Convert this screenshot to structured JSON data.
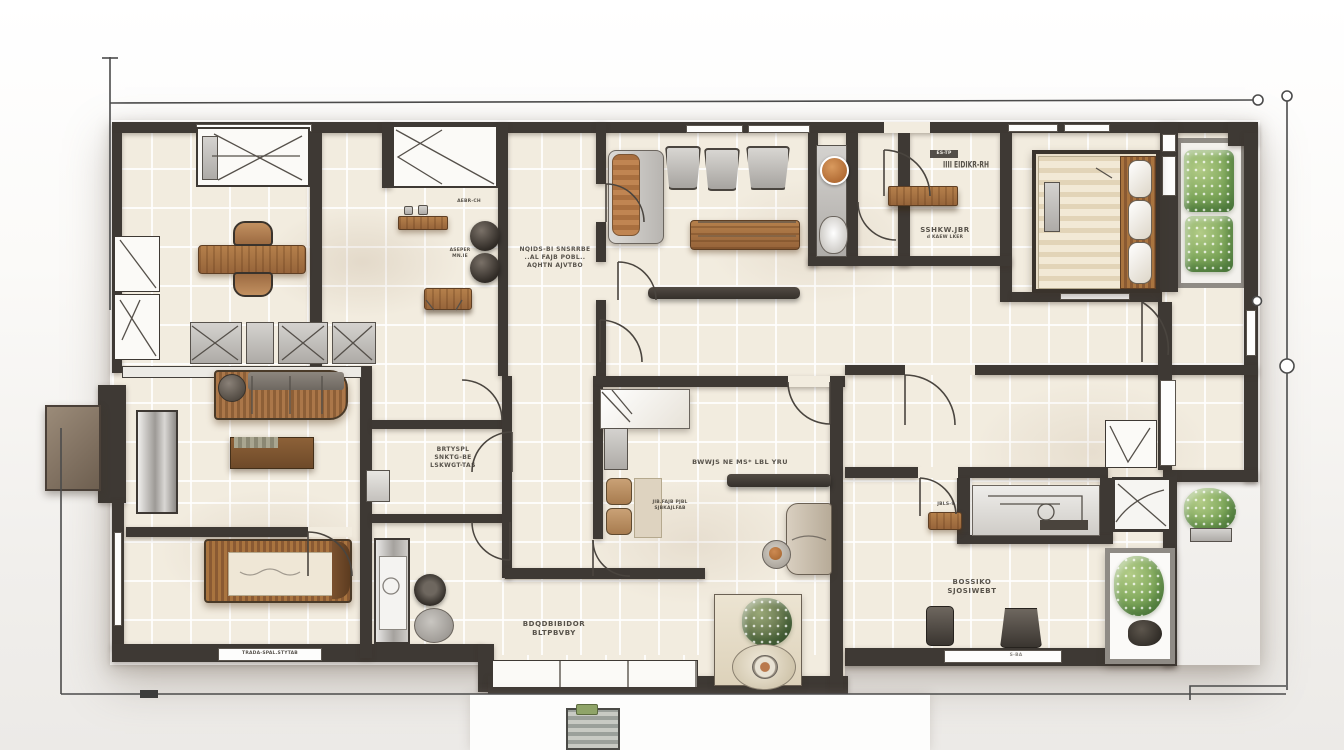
{
  "palette": {
    "wall": "#3e3934",
    "floor_tile": "#f2ecdf",
    "grout": "#fbf8f1",
    "wood": "#a9743f",
    "wood_dark": "#7c5533",
    "furniture_gray": "#b9b6b2",
    "accent_orange": "#c07840",
    "plant_green": "#7ea75a",
    "paper": "#f7f6f3",
    "survey_line": "#4b4b4b"
  },
  "labels": {
    "corridor": [
      "NQIDS-BI SNSRRBE",
      "..AL FAJB POBL..",
      "AQHTN AJVTBO"
    ],
    "study_title": "SSHKW.JBR",
    "study_sub": "d KAEW LKER",
    "study_barcode": "IIII EIDIKR-RH",
    "study_tag": "ES-TP",
    "shelf_tag_1": "ASEPER",
    "shelf_tag_2": "MN.IE",
    "closet_tag": "AEBR-CH",
    "bath": [
      "BRTYSPL",
      "SNKTG-BE",
      "LSKWGT-TAS"
    ],
    "center_room_main": "BWWJS NE MS* LBL YRU",
    "center_room_small": [
      "JIB.FAJB PJBL",
      "SJBKAJLFAB"
    ],
    "great_room": [
      "BDQDBIBIDOR",
      "BLTPBVBY"
    ],
    "window_strip": "TRADA-SPAL.STYTAB",
    "office": [
      "BOSSIKO",
      "SJOSIWEBT"
    ],
    "stool_tag": "JBLS-9",
    "counter_tag": "S-BA"
  },
  "rooms": {
    "dining_room": {
      "furniture": [
        "window-daybed",
        "dining-table",
        "dining-chair",
        "dining-chair",
        "wall-cabinet",
        "wall-cabinet",
        "pot-shelf",
        "planter-pot",
        "planter-pot",
        "wood-wall-shelf",
        "lounge-chair",
        "lounge-chair",
        "lounge-chair",
        "bench-band"
      ]
    },
    "stair_closet": {
      "furniture": [
        "x-brace-closet"
      ]
    },
    "living_room": {
      "furniture": [
        "chaise-sofa",
        "tub-chair",
        "tub-chair",
        "tub-chair",
        "coffee-table",
        "wall-bench"
      ]
    },
    "shower_room": {
      "furniture": [
        "shower-panel",
        "round-basin",
        "toilet"
      ]
    },
    "study": {
      "furniture": [
        "wall-shelf"
      ]
    },
    "master_bedroom": {
      "furniture": [
        "double-bed",
        "bed-pillows",
        "side-panel",
        "wardrobe-strip"
      ]
    },
    "balcony": {
      "furniture": [
        "planter-box",
        "planter-box"
      ]
    },
    "family_room": {
      "furniture": [
        "slat-sofa",
        "console-sideboard",
        "metal-wardrobe",
        "wood-frame-bed"
      ]
    },
    "bathroom_center": {
      "furniture": [
        "sink-sketch"
      ]
    },
    "utility_room": {
      "furniture": [
        "washing-machine",
        "dark-toilet",
        "round-rug"
      ]
    },
    "center_bedroom": {
      "furniture": [
        "white-bed",
        "side-cabinet",
        "tan-chair",
        "tan-chair",
        "floor-mat",
        "wall-shelf-dark",
        "armchair",
        "round-side-table"
      ]
    },
    "great_room_bottom": {
      "furniture": [
        "sideboard",
        "flower-cabinet",
        "round-tray"
      ]
    },
    "office_bottom_right": {
      "furniture": [
        "desk-chair",
        "desk-chair",
        "counter",
        "wood-stool",
        "vanity",
        "corner-shower",
        "glass-planter",
        "outdoor-plant",
        "v-chair"
      ]
    },
    "patio": {
      "furniture": [
        "grill-unit"
      ]
    },
    "entry": {
      "furniture": [
        "canopy-pad"
      ]
    }
  }
}
